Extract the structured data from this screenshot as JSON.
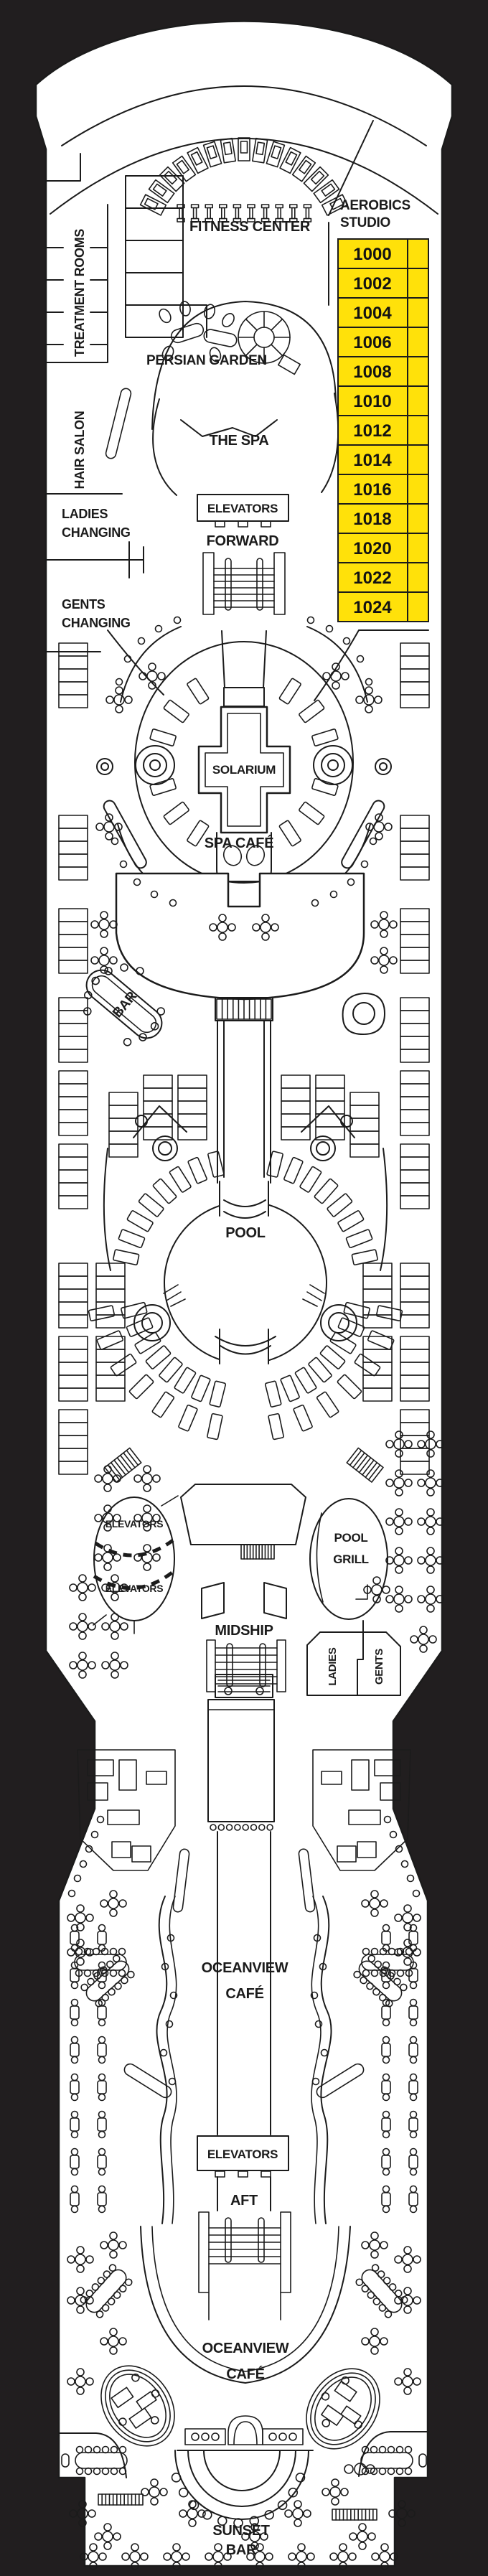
{
  "colors": {
    "background": "#211E1F",
    "deck": "#FFFFFF",
    "line": "#1B1B1B",
    "cabin_fill": "#FFE10A",
    "cabin_text": "#131313"
  },
  "labels": {
    "aerobics_studio_line1": "AEROBICS",
    "aerobics_studio_line2": "STUDIO",
    "fitness_center": "FITNESS CENTER",
    "treatment_rooms": "TREATMENT ROOMS",
    "persian_garden": "PERSIAN GARDEN",
    "hair_salon": "HAIR SALON",
    "the_spa": "THE SPA",
    "elevators_forward": "ELEVATORS",
    "forward": "FORWARD",
    "ladies_changing_line1": "LADIES",
    "ladies_changing_line2": "CHANGING",
    "gents_changing_line1": "GENTS",
    "gents_changing_line2": "CHANGING",
    "solarium": "SOLARIUM",
    "spa_cafe": "SPA CAFÉ",
    "bar": "BAR",
    "pool": "POOL",
    "elevators_mid_top": "ELEVATORS",
    "elevators_mid_bottom": "ELEVATORS",
    "pool_grill_line1": "POOL",
    "pool_grill_line2": "GRILL",
    "midship": "MIDSHIP",
    "ladies": "LADIES",
    "gents": "GENTS",
    "oceanview_cafe_line1": "OCEANVIEW",
    "oceanview_cafe_line2": "CAFÉ",
    "elevators_aft": "ELEVATORS",
    "aft": "AFT",
    "oceanview_cafe_aft_line1": "OCEANVIEW",
    "oceanview_cafe_aft_line2": "CAFÉ",
    "sunset_bar_line1": "SUNSET",
    "sunset_bar_line2": "BAR"
  },
  "cabins": {
    "numbers": [
      "1000",
      "1002",
      "1004",
      "1006",
      "1008",
      "1010",
      "1012",
      "1014",
      "1016",
      "1018",
      "1020",
      "1022",
      "1024"
    ]
  }
}
